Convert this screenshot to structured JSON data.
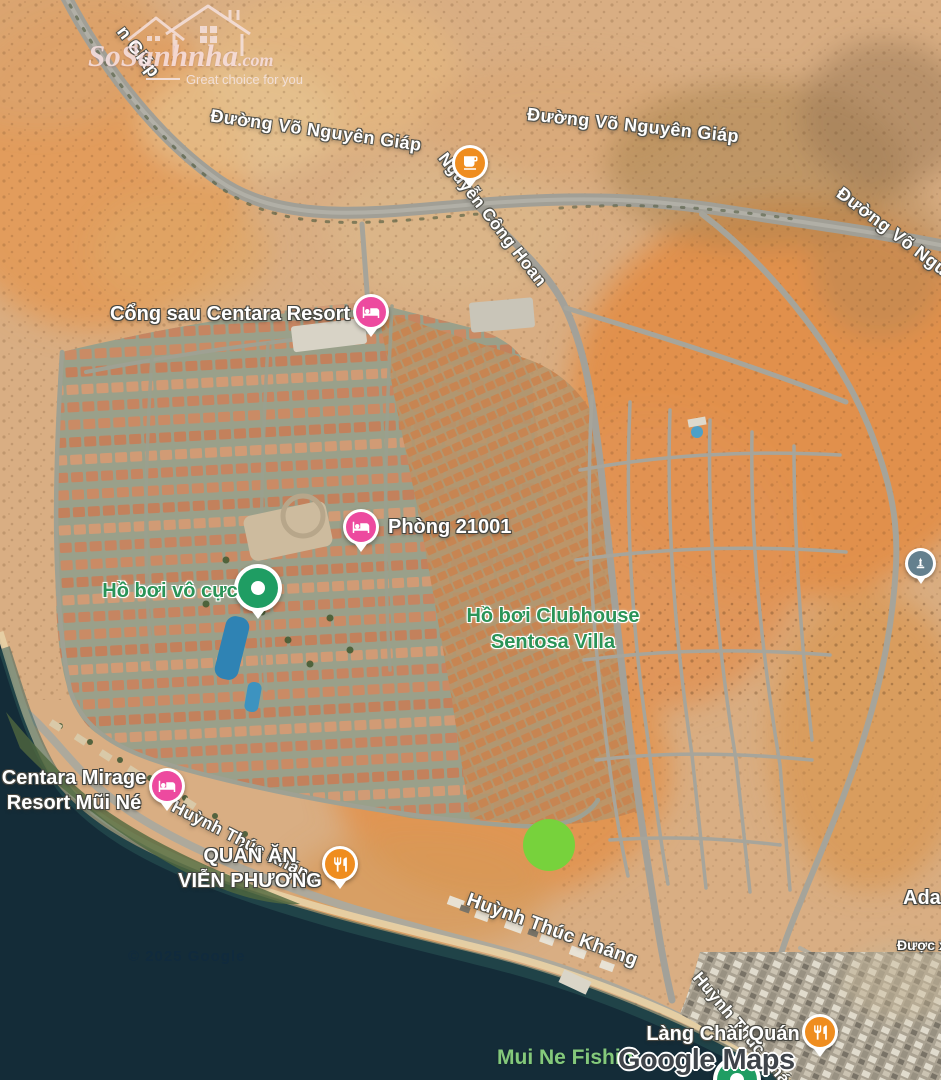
{
  "brand": {
    "name": "SoSanhnha",
    "suffix": ".com",
    "tagline": "Great choice for you"
  },
  "road_labels": {
    "vng_corner_tl": "n Giáp",
    "vng_left": "Đường Võ Nguyên Giáp",
    "vng_right": "Đường Võ Nguyên Giáp",
    "vng_corner_tr": "Đường Võ Ngu",
    "nguyen_cong_hoan": "Nguyễn Công Hoan",
    "huynh_thuc_upper": "Huỳnh Thúc Kháng",
    "huynh_thuc_main": "Huỳnh Thúc Kháng",
    "huynh_thuc_bottom": "Huỳnh Thúc Kháng"
  },
  "poi_labels": {
    "cong_sau": "Cổng sau Centara Resort",
    "phong": "Phòng 21001",
    "ho_boi_vo_cuc": "Hồ bơi vô cực",
    "clubhouse_line1": "Hồ bơi Clubhouse",
    "clubhouse_line2": "Sentosa Villa",
    "centara_line1": "Centara Mirage",
    "centara_line2": "Resort Mũi Né",
    "quan_an_line1": "QUÁN ĂN",
    "quan_an_line2": "VIỄN PHƯƠNG",
    "lang_chai": "Làng Chài Quán",
    "ada_partial": "Ada",
    "duoc_partial": "Được x",
    "mui_ne_fishing": "Mui Ne Fishin"
  },
  "attribution": {
    "copyright": "© 2025 Google",
    "maps_logo": "Google Maps"
  },
  "markers": [
    {
      "id": "cafe",
      "icon": "coffee-cup-icon",
      "color": "#ef8d1f"
    },
    {
      "id": "hotel-cong-sau",
      "icon": "bed-icon",
      "color": "#ed4a9f"
    },
    {
      "id": "hotel-phong-21001",
      "icon": "bed-icon",
      "color": "#ed4a9f"
    },
    {
      "id": "pool-vo-cuc",
      "icon": "dot-icon",
      "color": "#1f9d63"
    },
    {
      "id": "attraction-monument",
      "icon": "monument-icon",
      "color": "#64808e"
    },
    {
      "id": "hotel-centara-mirage",
      "icon": "bed-icon",
      "color": "#ed4a9f"
    },
    {
      "id": "restaurant-vien-phuong",
      "icon": "fork-knife-icon",
      "color": "#ef8d1f"
    },
    {
      "id": "listing-highlight",
      "icon": "circle-highlight",
      "color": "#77d23c"
    },
    {
      "id": "restaurant-lang-chai",
      "icon": "fork-knife-icon",
      "color": "#ef8d1f"
    },
    {
      "id": "poi-bottom-green",
      "icon": "dot-icon",
      "color": "#1f9d63"
    }
  ],
  "colors": {
    "water": "#142c38",
    "sand": "#d9ae83",
    "dune_orange": "#e28e49",
    "label_green": "#2a9357",
    "road_gray": "#a3a199"
  }
}
